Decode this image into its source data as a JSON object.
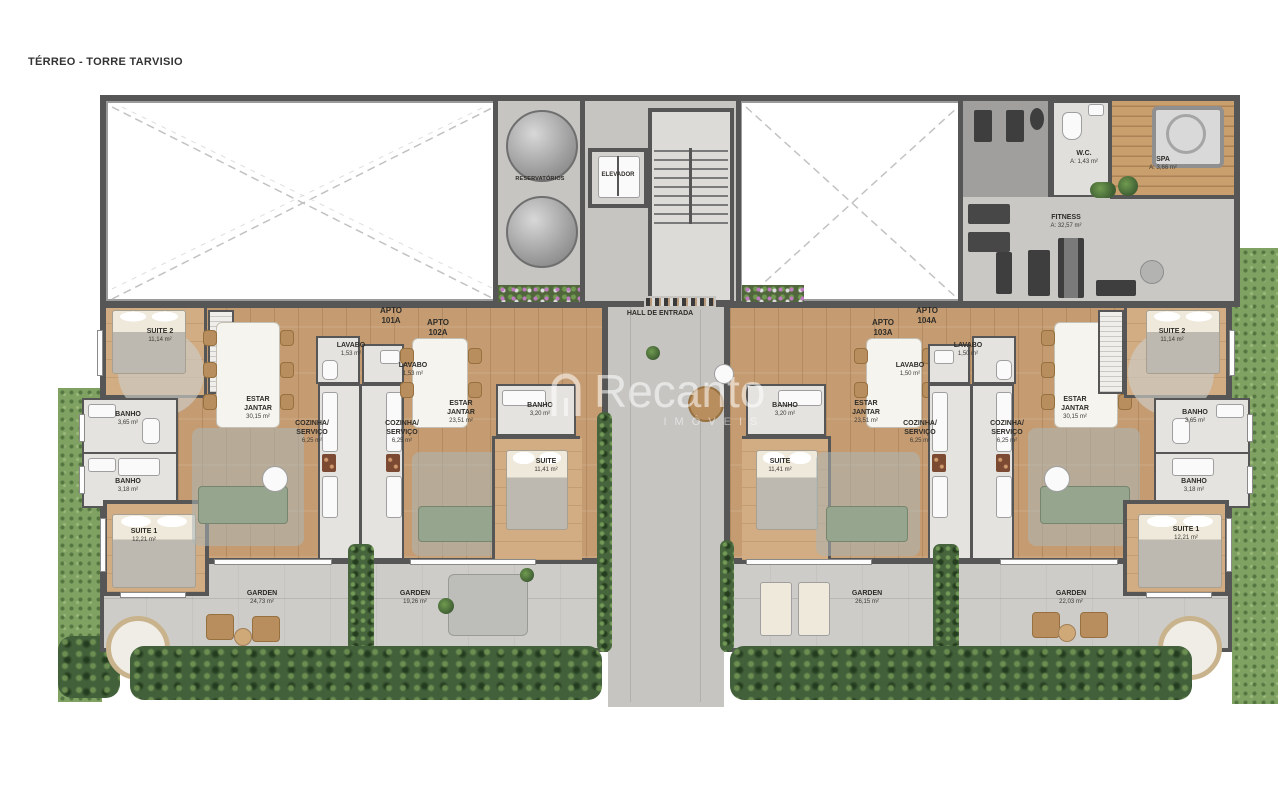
{
  "title": "TÉRREO - TORRE TARVISIO",
  "watermark": {
    "brand": "Recanto",
    "tagline": "IMÓVEIS"
  },
  "common_areas": {
    "reservatorios": "RESERVATÓRIOS",
    "elevador": "ELEVADOR",
    "hall_entrada": "HALL DE ENTRADA",
    "wc": {
      "label": "W.C.",
      "area": "A: 1,43 m²"
    },
    "spa": {
      "label": "SPA",
      "area": "A: 3,66 m²"
    },
    "fitness": {
      "label": "FITNESS",
      "area": "A: 32,57 m²"
    }
  },
  "apartments": [
    {
      "tag": "APTO\n101A",
      "rooms": [
        {
          "label": "SUITE 2",
          "area": "11,14 m²"
        },
        {
          "label": "BANHO",
          "area": "3,65 m²"
        },
        {
          "label": "BANHO",
          "area": "3,18 m²"
        },
        {
          "label": "SUITE 1",
          "area": "12,21 m²"
        },
        {
          "label": "ESTAR\nJANTAR",
          "area": "30,15 m²"
        },
        {
          "label": "COZINHA/\nSERVIÇO",
          "area": "6,25 m²"
        },
        {
          "label": "LAVABO",
          "area": "1,53 m²"
        },
        {
          "label": "GARDEN",
          "area": "24,73 m²"
        }
      ]
    },
    {
      "tag": "APTO\n102A",
      "rooms": [
        {
          "label": "LAVABO",
          "area": "1,53 m²"
        },
        {
          "label": "COZINHA/\nSERVIÇO",
          "area": "6,25 m²"
        },
        {
          "label": "ESTAR\nJANTAR",
          "area": "23,51 m²"
        },
        {
          "label": "BANHO",
          "area": "3,20 m²"
        },
        {
          "label": "SUITE",
          "area": "11,41 m²"
        },
        {
          "label": "GARDEN",
          "area": "19,26 m²"
        }
      ]
    },
    {
      "tag": "APTO\n103A",
      "rooms": [
        {
          "label": "BANHO",
          "area": "3,20 m²"
        },
        {
          "label": "SUITE",
          "area": "11,41 m²"
        },
        {
          "label": "ESTAR\nJANTAR",
          "area": "23,51 m²"
        },
        {
          "label": "LAVABO",
          "area": "1,50 m²"
        },
        {
          "label": "COZINHA/\nSERVIÇO",
          "area": "6,25 m²"
        },
        {
          "label": "GARDEN",
          "area": "26,15 m²"
        }
      ]
    },
    {
      "tag": "APTO\n104A",
      "rooms": [
        {
          "label": "LAVABO",
          "area": "1,50 m²"
        },
        {
          "label": "COZINHA/\nSERVIÇO",
          "area": "6,25 m²"
        },
        {
          "label": "ESTAR\nJANTAR",
          "area": "30,15 m²"
        },
        {
          "label": "SUITE 2",
          "area": "11,14 m²"
        },
        {
          "label": "BANHO",
          "area": "3,65 m²"
        },
        {
          "label": "BANHO",
          "area": "3,18 m²"
        },
        {
          "label": "SUITE 1",
          "area": "12,21 m²"
        },
        {
          "label": "GARDEN",
          "area": "22,03 m²"
        }
      ]
    }
  ]
}
